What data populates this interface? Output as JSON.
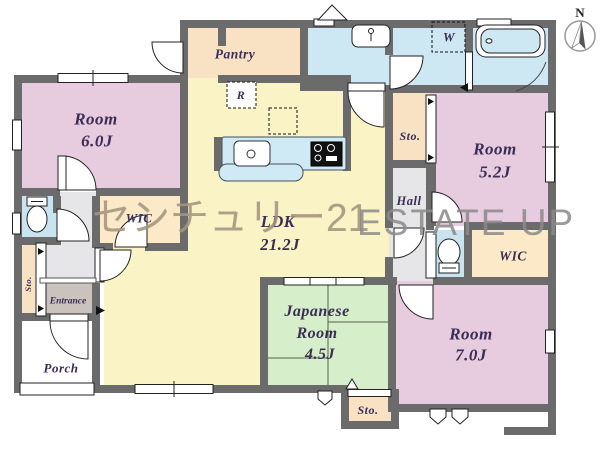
{
  "title": "floor-plan",
  "watermark": {
    "brand_jp": "センチュリー21",
    "brand_en": "ESTATE UP"
  },
  "compass": {
    "north_label": "N"
  },
  "labels": {
    "room_6_0": {
      "name": "Room",
      "size": "6.0J"
    },
    "pantry": "Pantry",
    "refrigerator": "R",
    "washer": "W",
    "ldk": {
      "name": "LDK",
      "size": "21.2J"
    },
    "sto_right": "Sto.",
    "hall": "Hall",
    "room_5_2": {
      "name": "Room",
      "size": "5.2J"
    },
    "wic_right": "WIC",
    "wic_left": "WIC",
    "sto_left": "Sto.",
    "entrance": "Entrance",
    "porch": "Porch",
    "japanese_room": {
      "line1": "Japanese",
      "line2": "Room",
      "size": "4.5J"
    },
    "room_7_0": {
      "name": "Room",
      "size": "7.0J"
    },
    "sto_bottom": "Sto."
  },
  "colors": {
    "wall": "#6b6b6b",
    "room_pink": "#e7cbdf",
    "ldk_yellow": "#faf3c5",
    "pantry_peach": "#f9e2c4",
    "wet_blue": "#cde7f3",
    "tatami_green": "#d6efca",
    "hall_gray": "#e6e6e8",
    "entrance_taupe": "#c9c2bd",
    "label_ink": "#3a2d56",
    "watermark_jp": "#a3947d",
    "watermark_en": "#8a8a8a"
  }
}
